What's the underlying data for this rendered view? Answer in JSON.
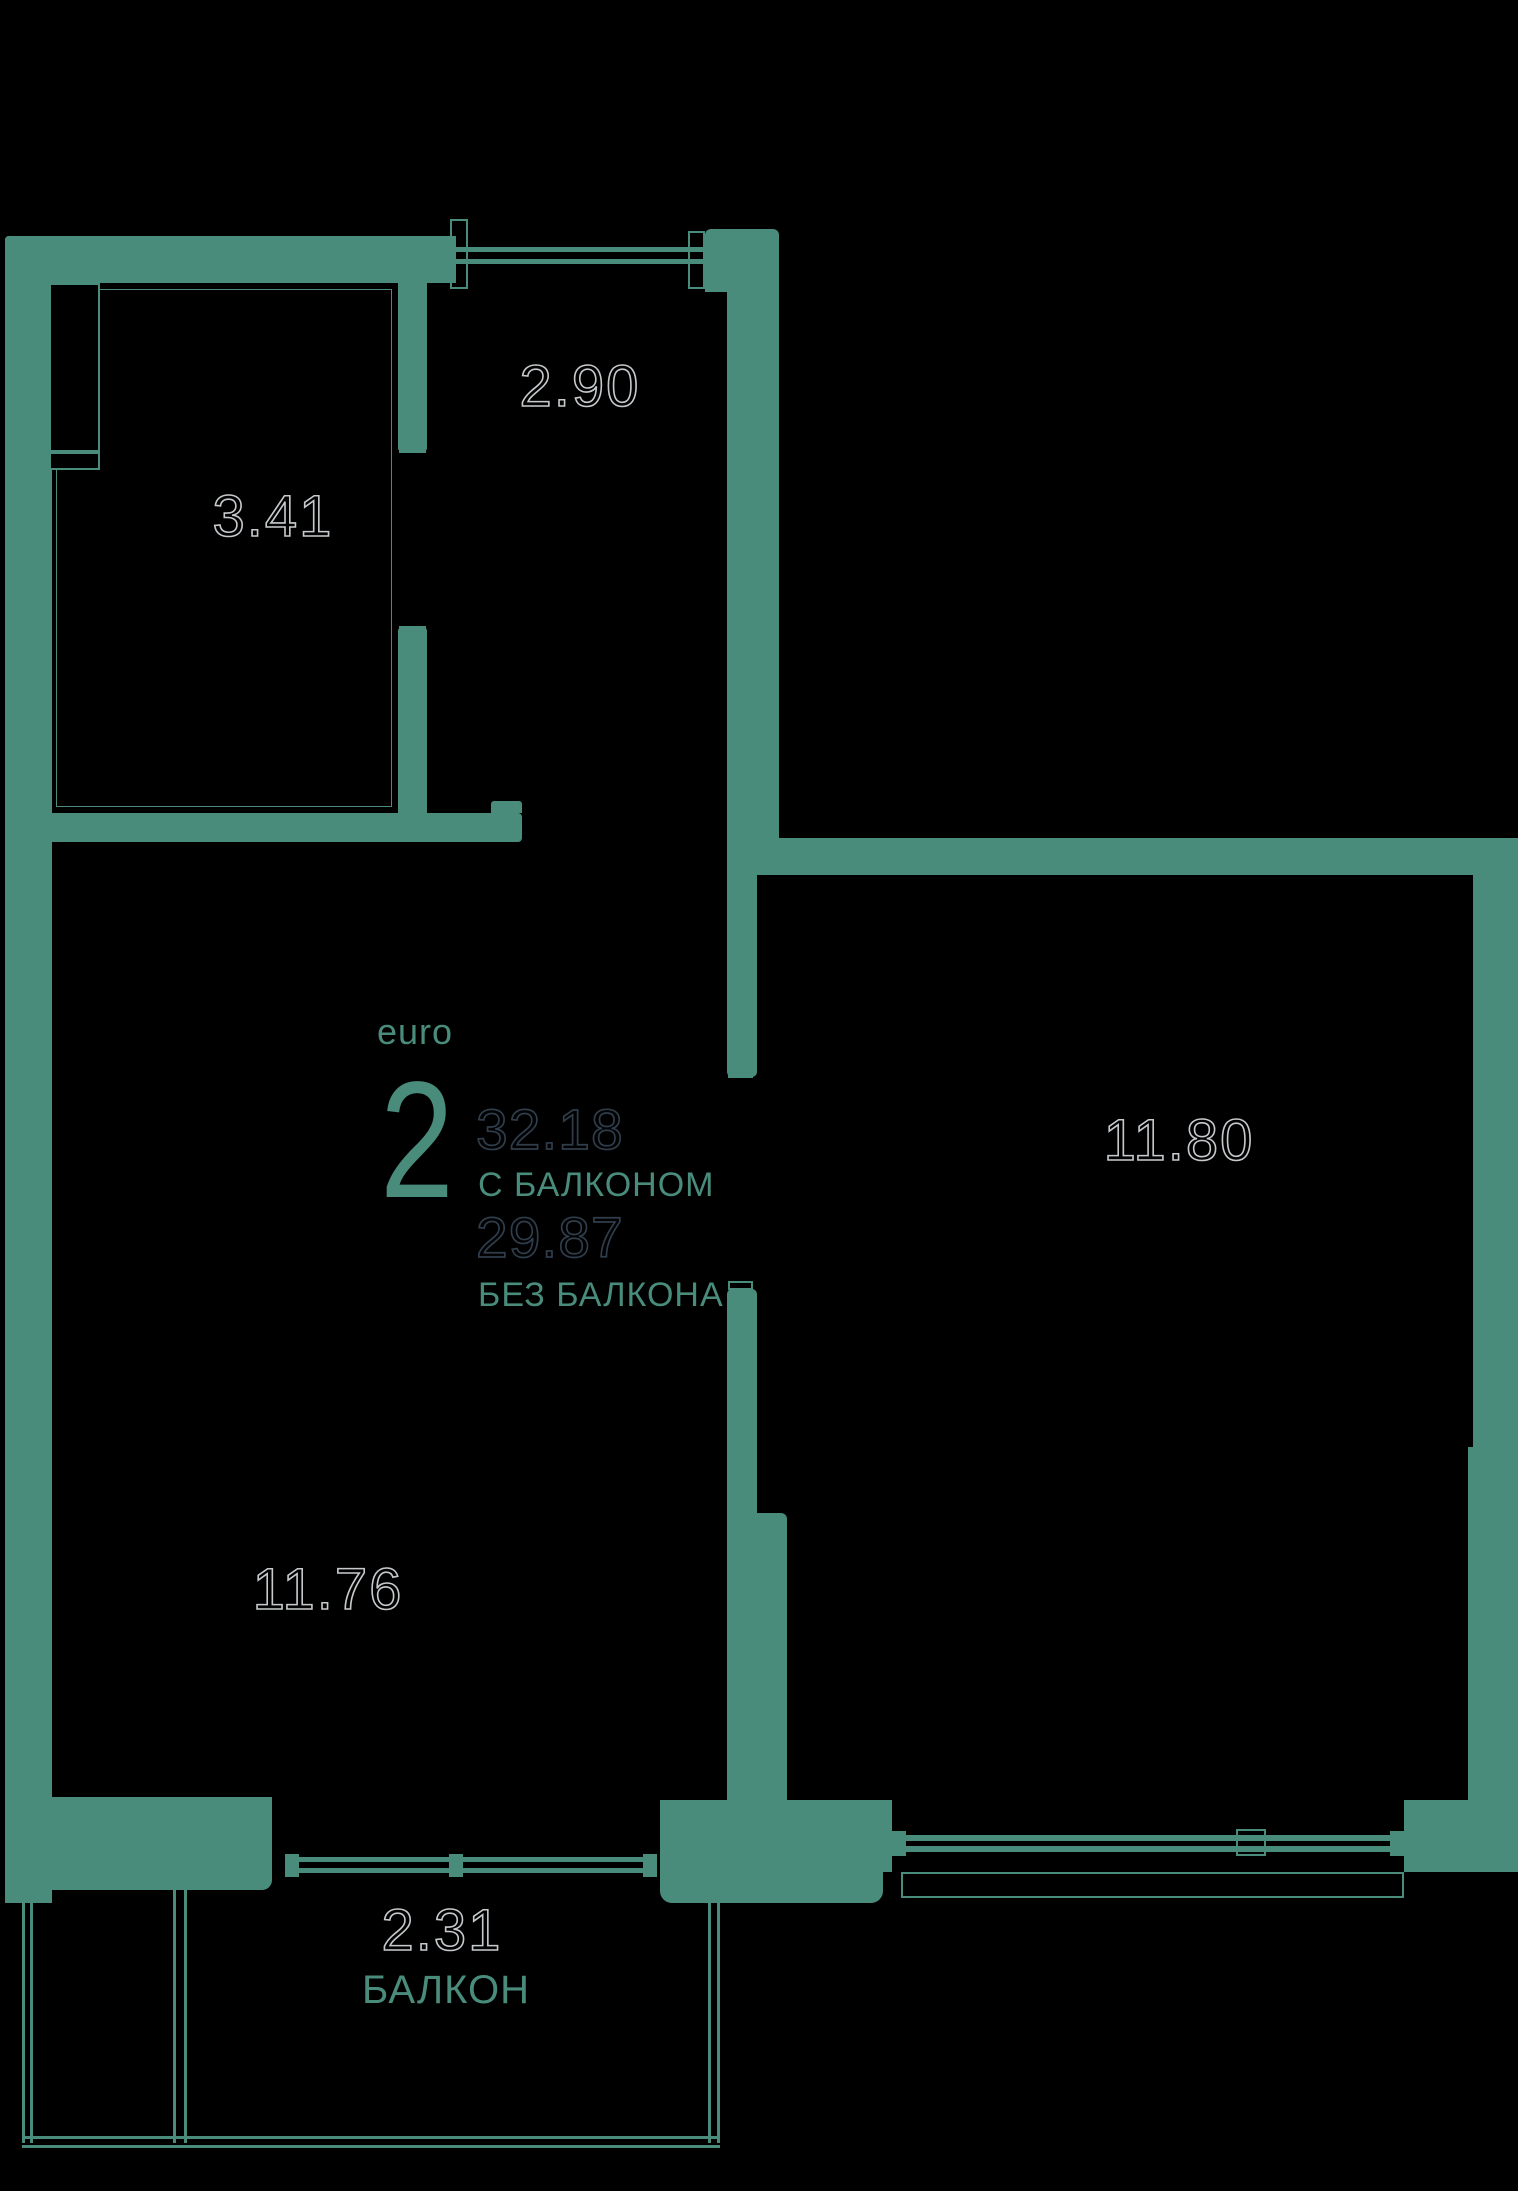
{
  "floor_plan": {
    "unit": {
      "type_label": "euro",
      "type_number": "2",
      "area_with_balcony": "32.18",
      "with_balcony_label": "С БАЛКОНОМ",
      "area_without_balcony": "29.87",
      "without_balcony_label": "БЕЗ БАЛКОНА"
    },
    "rooms": [
      {
        "name": "hallway",
        "area": "2.90"
      },
      {
        "name": "bathroom",
        "area": "3.41"
      },
      {
        "name": "room-right",
        "area": "11.80"
      },
      {
        "name": "room-left",
        "area": "11.76"
      },
      {
        "name": "balcony",
        "area": "2.31",
        "label": "БАЛКОН"
      }
    ],
    "colors": {
      "background": "#000000",
      "wall": "#4a8c7c",
      "accent_text": "#4a8c7c",
      "dimension_outline": "#c6cacc",
      "area_outline": "#2f3d4c"
    }
  }
}
